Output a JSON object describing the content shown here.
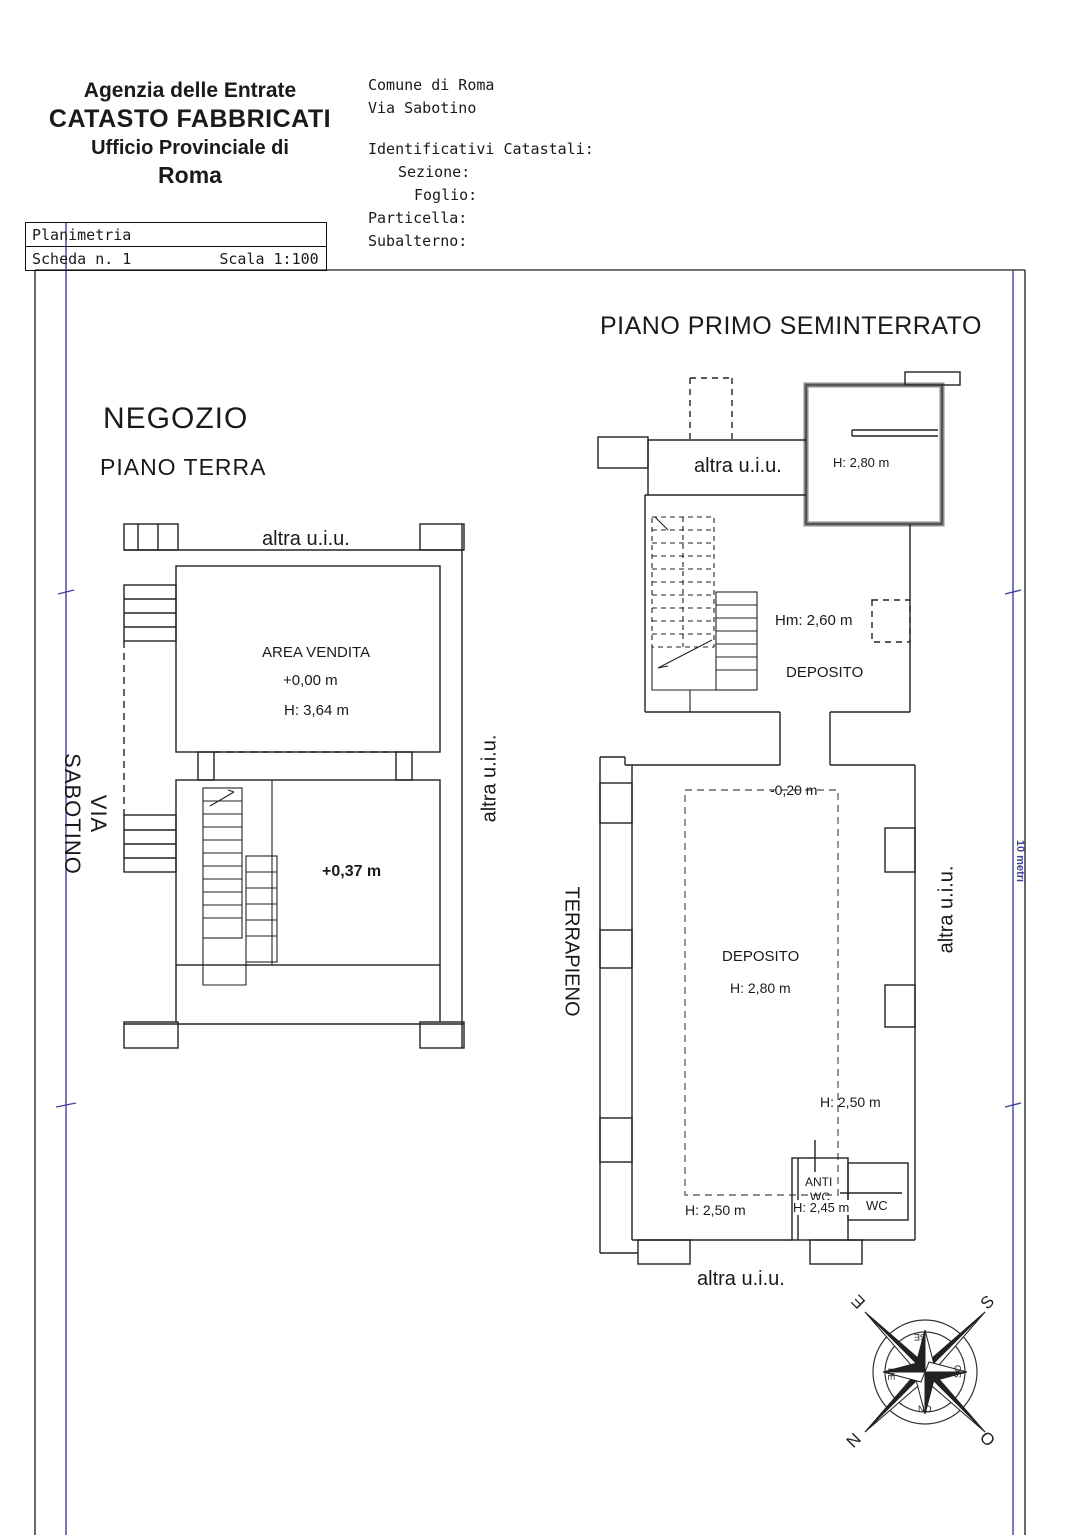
{
  "header": {
    "agency": {
      "line1": "Agenzia delle Entrate",
      "line2": "CATASTO FABBRICATI",
      "line3": "Ufficio Provinciale di",
      "line4": "Roma"
    },
    "location": {
      "comune": "Comune di Roma",
      "via": "Via Sabotino",
      "identificativi": "Identificativi Catastali:",
      "sezione": "Sezione:",
      "foglio": "Foglio:",
      "particella": "Particella:",
      "subalterno": "Subalterno:"
    },
    "sheet": {
      "title": "Planimetria",
      "scheda": "Scheda n. 1",
      "scala": "Scala 1:100"
    }
  },
  "ground_floor": {
    "name": "NEGOZIO",
    "level": "PIANO TERRA",
    "labels": {
      "top_boundary": "altra u.i.u.",
      "room": "AREA VENDITA",
      "elevation": "+0,00 m",
      "height": "H: 3,64 m",
      "stair_room_elevation": "+0,37 m",
      "street": "VIA SABOTINO",
      "right_boundary": "altra u.i.u."
    }
  },
  "basement_floor": {
    "level": "PIANO PRIMO SEMINTERRATO",
    "labels": {
      "top_boundary": "altra u.i.u.",
      "small_room_height": "H: 2,80 m",
      "mezzanine_height": "Hm: 2,60 m",
      "upper_room": "DEPOSITO",
      "elevation": "-0,20 m",
      "left_boundary": "TERRAPIENO",
      "right_boundary": "altra u.i.u.",
      "main_room": "DEPOSITO",
      "main_room_height": "H: 2,80 m",
      "height_right": "H: 2,50 m",
      "height_left": "H: 2,50 m",
      "anti_wc_line1": "ANTI",
      "anti_wc_line2": "WC",
      "anti_wc_height": "H: 2,45 m",
      "wc": "WC",
      "bottom_boundary": "altra u.i.u."
    }
  },
  "scale_bar": {
    "label": "10 metri",
    "color": "#4040a0"
  },
  "compass": {
    "cardinal": {
      "e": "E",
      "s": "S",
      "n": "N",
      "o": "O"
    },
    "inter": {
      "se": "SE",
      "ne": "NE",
      "so": "SO",
      "no": "NO"
    }
  }
}
